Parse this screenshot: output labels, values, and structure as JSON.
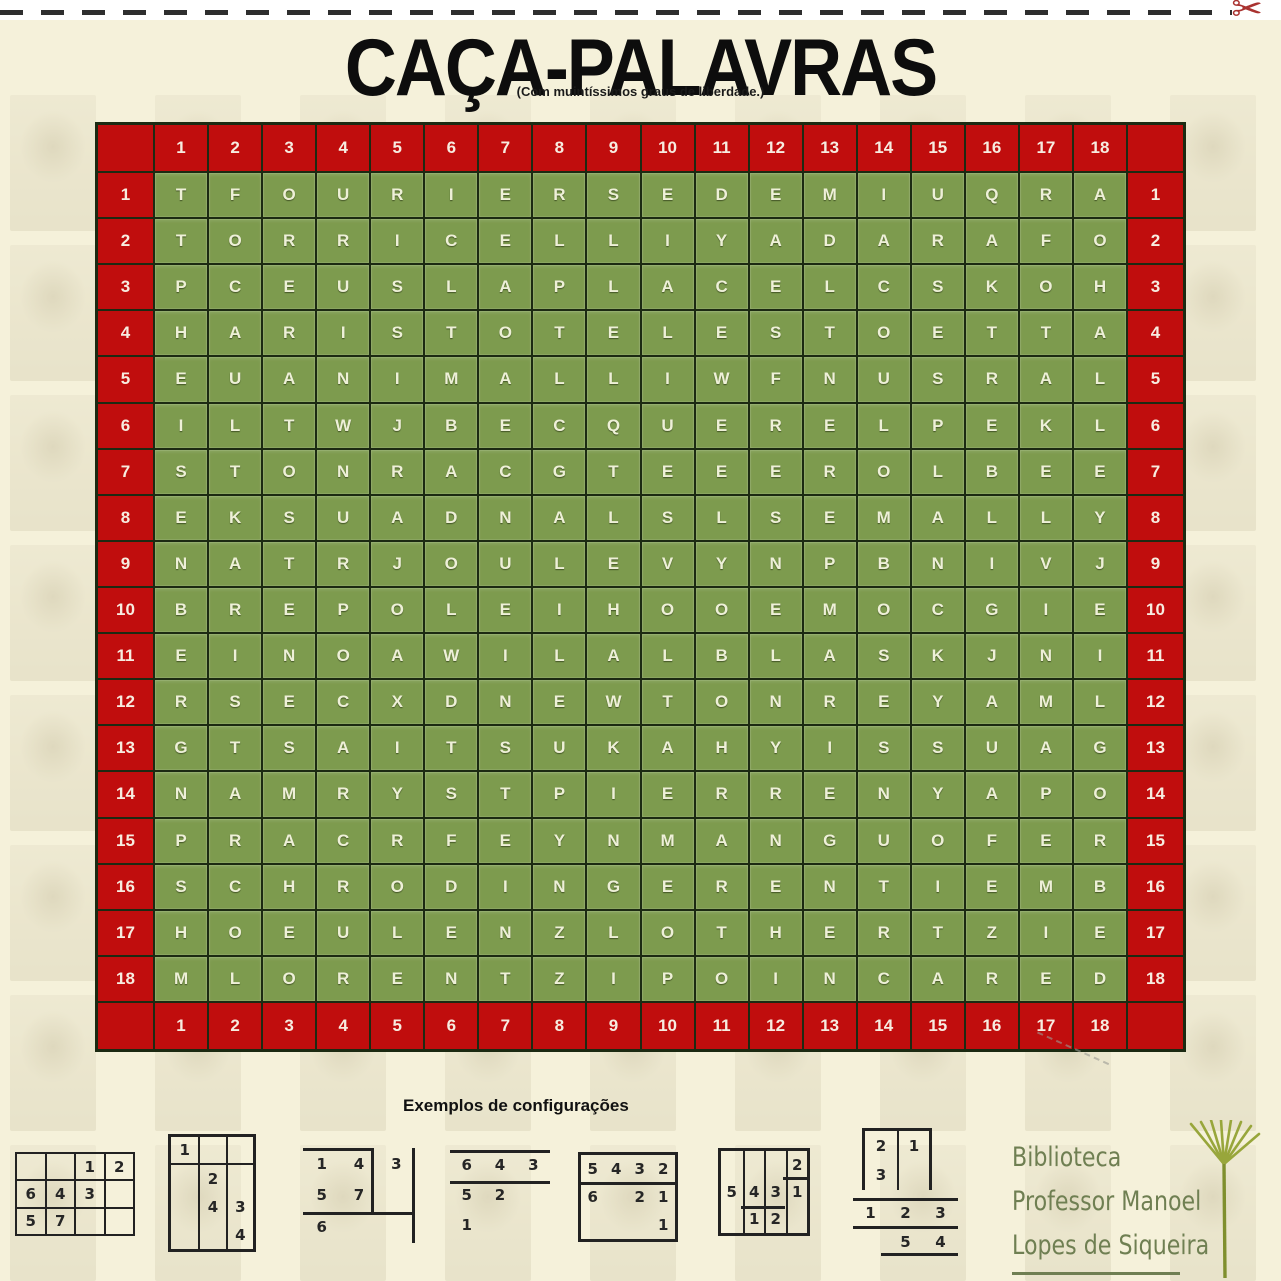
{
  "page": {
    "title": "CAÇA-PALAVRAS",
    "subtitle": "(Com muintíssimos graus de liberdade.)"
  },
  "puzzle": {
    "col_headers": [
      "1",
      "2",
      "3",
      "4",
      "5",
      "6",
      "7",
      "8",
      "9",
      "10",
      "11",
      "12",
      "13",
      "14",
      "15",
      "16",
      "17",
      "18"
    ],
    "row_headers": [
      "1",
      "2",
      "3",
      "4",
      "5",
      "6",
      "7",
      "8",
      "9",
      "10",
      "11",
      "12",
      "13",
      "14",
      "15",
      "16",
      "17",
      "18"
    ],
    "rows": [
      "TFOURIERSEDEMIUQRA",
      "TORRICELLIYADARAFO",
      "PCEUSLAPLACELCSKOH",
      "HARISTOTELESTOETTA",
      "EUANIMALLIWFNUSRAL",
      "ILTWJBECQUERELPEKL",
      "STONRACGTEEEROLBEE",
      "EKSUADNALSLSEMALLY",
      "NATRJOULEVYNPBNIVJ",
      "BREPOLEIHOOEMOCGIE",
      "EINOAWILALBLASKJNI",
      "RSECXDNEWTONREYAML",
      "GTSAITSUKAHYISSUAG",
      "NAMRYSTPIERRENYAPO",
      "PRACRFEYNMANGUOFER",
      "SCHRODINGERENTIEMB",
      "HOEULENZLOTHERTZIE",
      "MLORENTZIPOINCARED"
    ]
  },
  "examples": {
    "heading": "Exemplos de configurações",
    "items": [
      {
        "cells": [
          [
            "",
            "",
            "1",
            "2"
          ],
          [
            "6",
            "4",
            "3",
            ""
          ],
          [
            "5",
            "7",
            "",
            ""
          ]
        ]
      },
      {
        "cells": [
          [
            "1",
            "",
            ""
          ],
          [
            "",
            "2",
            ""
          ],
          [
            "",
            "4",
            "3"
          ],
          [
            "",
            "",
            "4"
          ]
        ]
      },
      {
        "cells": [
          [
            "1",
            "4",
            "3"
          ],
          [
            "5",
            "7",
            ""
          ],
          [
            "6",
            "",
            ""
          ]
        ]
      },
      {
        "cells": [
          [
            "6",
            "4",
            "3"
          ],
          [
            "5",
            "2",
            ""
          ],
          [
            "1",
            "",
            ""
          ]
        ]
      },
      {
        "cells": [
          [
            "5",
            "4",
            "3",
            "2"
          ],
          [
            "6",
            "",
            "2",
            "1"
          ],
          [
            "",
            "",
            "",
            "1"
          ]
        ]
      },
      {
        "cells": [
          [
            "",
            "",
            "",
            "2"
          ],
          [
            "5",
            "4",
            "3",
            "1"
          ],
          [
            "",
            "1",
            "2",
            ""
          ]
        ]
      },
      {
        "cells": [
          [
            "2",
            "1"
          ],
          [
            "3",
            ""
          ]
        ]
      },
      {
        "cells": [
          [
            "1",
            "2",
            "3"
          ],
          [
            "",
            "5",
            "4"
          ]
        ]
      }
    ]
  },
  "stamp": {
    "lines": [
      "Biblioteca",
      "Professor Manoel",
      "Lopes de Siqueira"
    ],
    "plant_icon": "papyrus-plant"
  },
  "icons": {
    "scissors": "✂"
  },
  "colors": {
    "red": "#c00d0d",
    "green": "#7d9b4e",
    "cream": "#f5f1da",
    "grid_line": "#1c2a12",
    "letter": "#eef0d8",
    "stamp_green": "#6f7f52"
  }
}
